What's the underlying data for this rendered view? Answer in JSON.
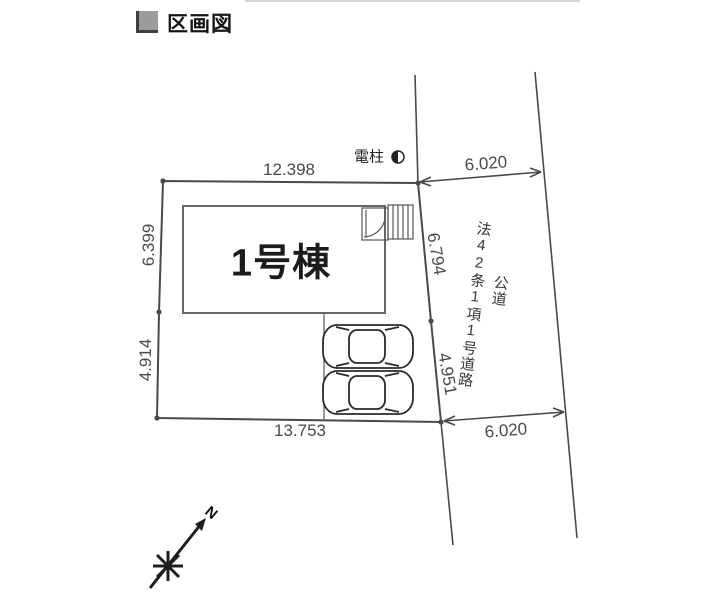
{
  "header": {
    "title": "区画図"
  },
  "plan": {
    "building": {
      "label": "1号棟"
    },
    "utility_pole": {
      "label": "電柱",
      "symbol": "half-filled-circle"
    },
    "road": {
      "designation": "法42条1項1号道路",
      "type": "公道"
    },
    "compass": {
      "north_label": "N"
    },
    "dimensions": {
      "top_edge": "12.398",
      "left_upper_edge": "6.399",
      "left_lower_edge": "4.914",
      "bottom_edge": "13.753",
      "right_upper_edge": "6.794",
      "right_lower_edge": "4.951",
      "road_width_top": "6.020",
      "road_width_bottom": "6.020"
    },
    "colors": {
      "line": "#4a4a4a",
      "dimension_text": "#4a4a4a",
      "building_text": "#1b1b1b",
      "title_icon": "#9c9c9c"
    }
  }
}
